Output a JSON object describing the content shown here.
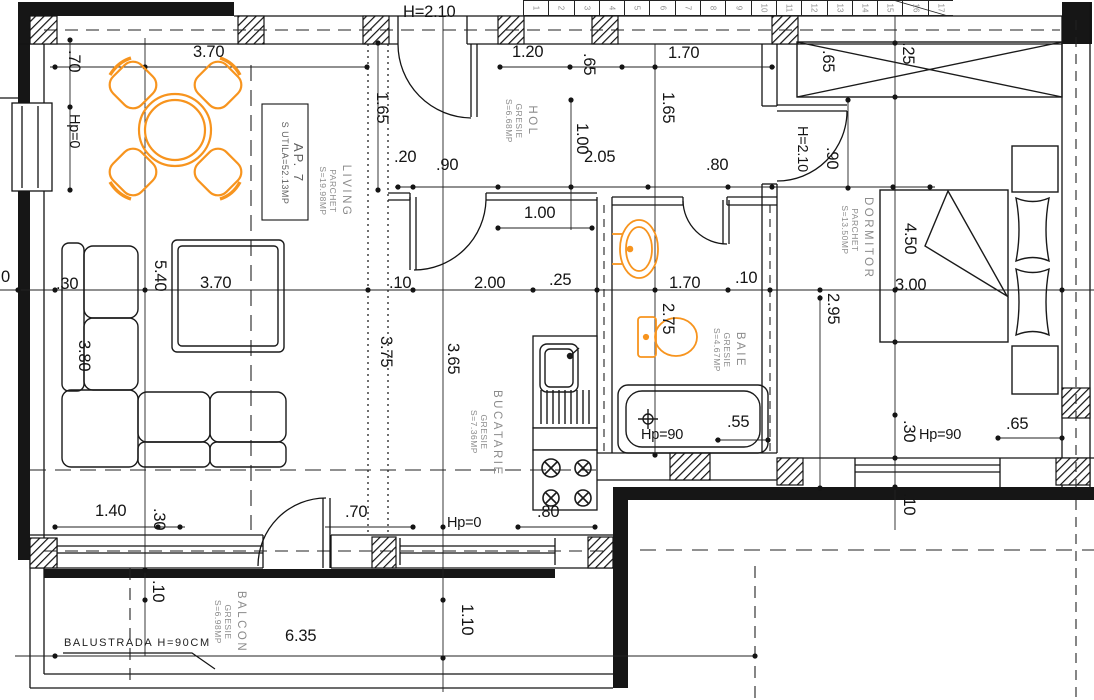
{
  "colors": {
    "line": "#141414",
    "accent": "#F7941E",
    "muted": "#8b8b8b"
  },
  "apartment": {
    "name": "AP. 7",
    "area": "S UTILA=52.13MP"
  },
  "rooms": {
    "living": {
      "name": "LIVING",
      "finish": "PARCHET",
      "area": "S=19.98MP"
    },
    "hol": {
      "name": "HOL",
      "finish": "GRESIE",
      "area": "S=6.68MP"
    },
    "dormitor": {
      "name": "DORMITOR",
      "finish": "PARCHET",
      "area": "S=13.50MP"
    },
    "baie": {
      "name": "BAIE",
      "finish": "GRESIE",
      "area": "S=4.67MP"
    },
    "bucatarie": {
      "name": "BUCATARIE",
      "finish": "GRESIE",
      "area": "S=7.36MP"
    },
    "balcon": {
      "name": "BALCON",
      "finish": "GRESIE",
      "area": "S=6.98MP"
    }
  },
  "notes": {
    "balustrade": "BALUSTRADA H=90CM"
  },
  "stairs": {
    "treads": [
      "1",
      "2",
      "3",
      "4",
      "5",
      "6",
      "7",
      "8",
      "9",
      "10",
      "11",
      "12",
      "13",
      "14",
      "15",
      "16",
      "17"
    ]
  },
  "dims": {
    "entry_height": "H=2.10",
    "living_top": "3.70",
    "hall_window": "1.20",
    "closet_top": "1.70",
    "living_side": ".70",
    "hp0_left": "Hp=0",
    "living_right_v": "1.65",
    "col_65": ".65",
    "hall_len_v": "1.65",
    "hall_door_v": "1.00",
    "ward_65": ".65",
    "ward_25": ".25",
    "bed_door_h": "H=2.10",
    "bed_door_w": ".90",
    "seg_20": ".20",
    "seg_90": ".90",
    "hall_len": "2.05",
    "bath_door": ".80",
    "kitchen_open": "1.00",
    "axis_zero": "0",
    "living_30": ".30",
    "living_len": "5.40",
    "living_mid": "3.70",
    "kitchen_10": ".10",
    "kitchen_200": "2.00",
    "counter_25": ".25",
    "bath_170": "1.70",
    "bath_10": ".10",
    "bed_300": "3.00",
    "bed_450": "4.50",
    "sofa_380": "3.80",
    "kitchen_375": "3.75",
    "kitchen_365": "3.65",
    "bath_275": "2.75",
    "bed_295": "2.95",
    "sofa_140": "1.40",
    "sofa_30": ".30",
    "kitchen_70": ".70",
    "hp0_bottom": "Hp=0",
    "stove_80": ".80",
    "bath_hp90": "Hp=90",
    "bath_55": ".55",
    "bed_30": ".30",
    "bed_hp90": "Hp=90",
    "bed_65": ".65",
    "bed_10": ".10",
    "balcony_10": ".10",
    "balcony_110": "1.10",
    "balcony_635": "6.35"
  }
}
